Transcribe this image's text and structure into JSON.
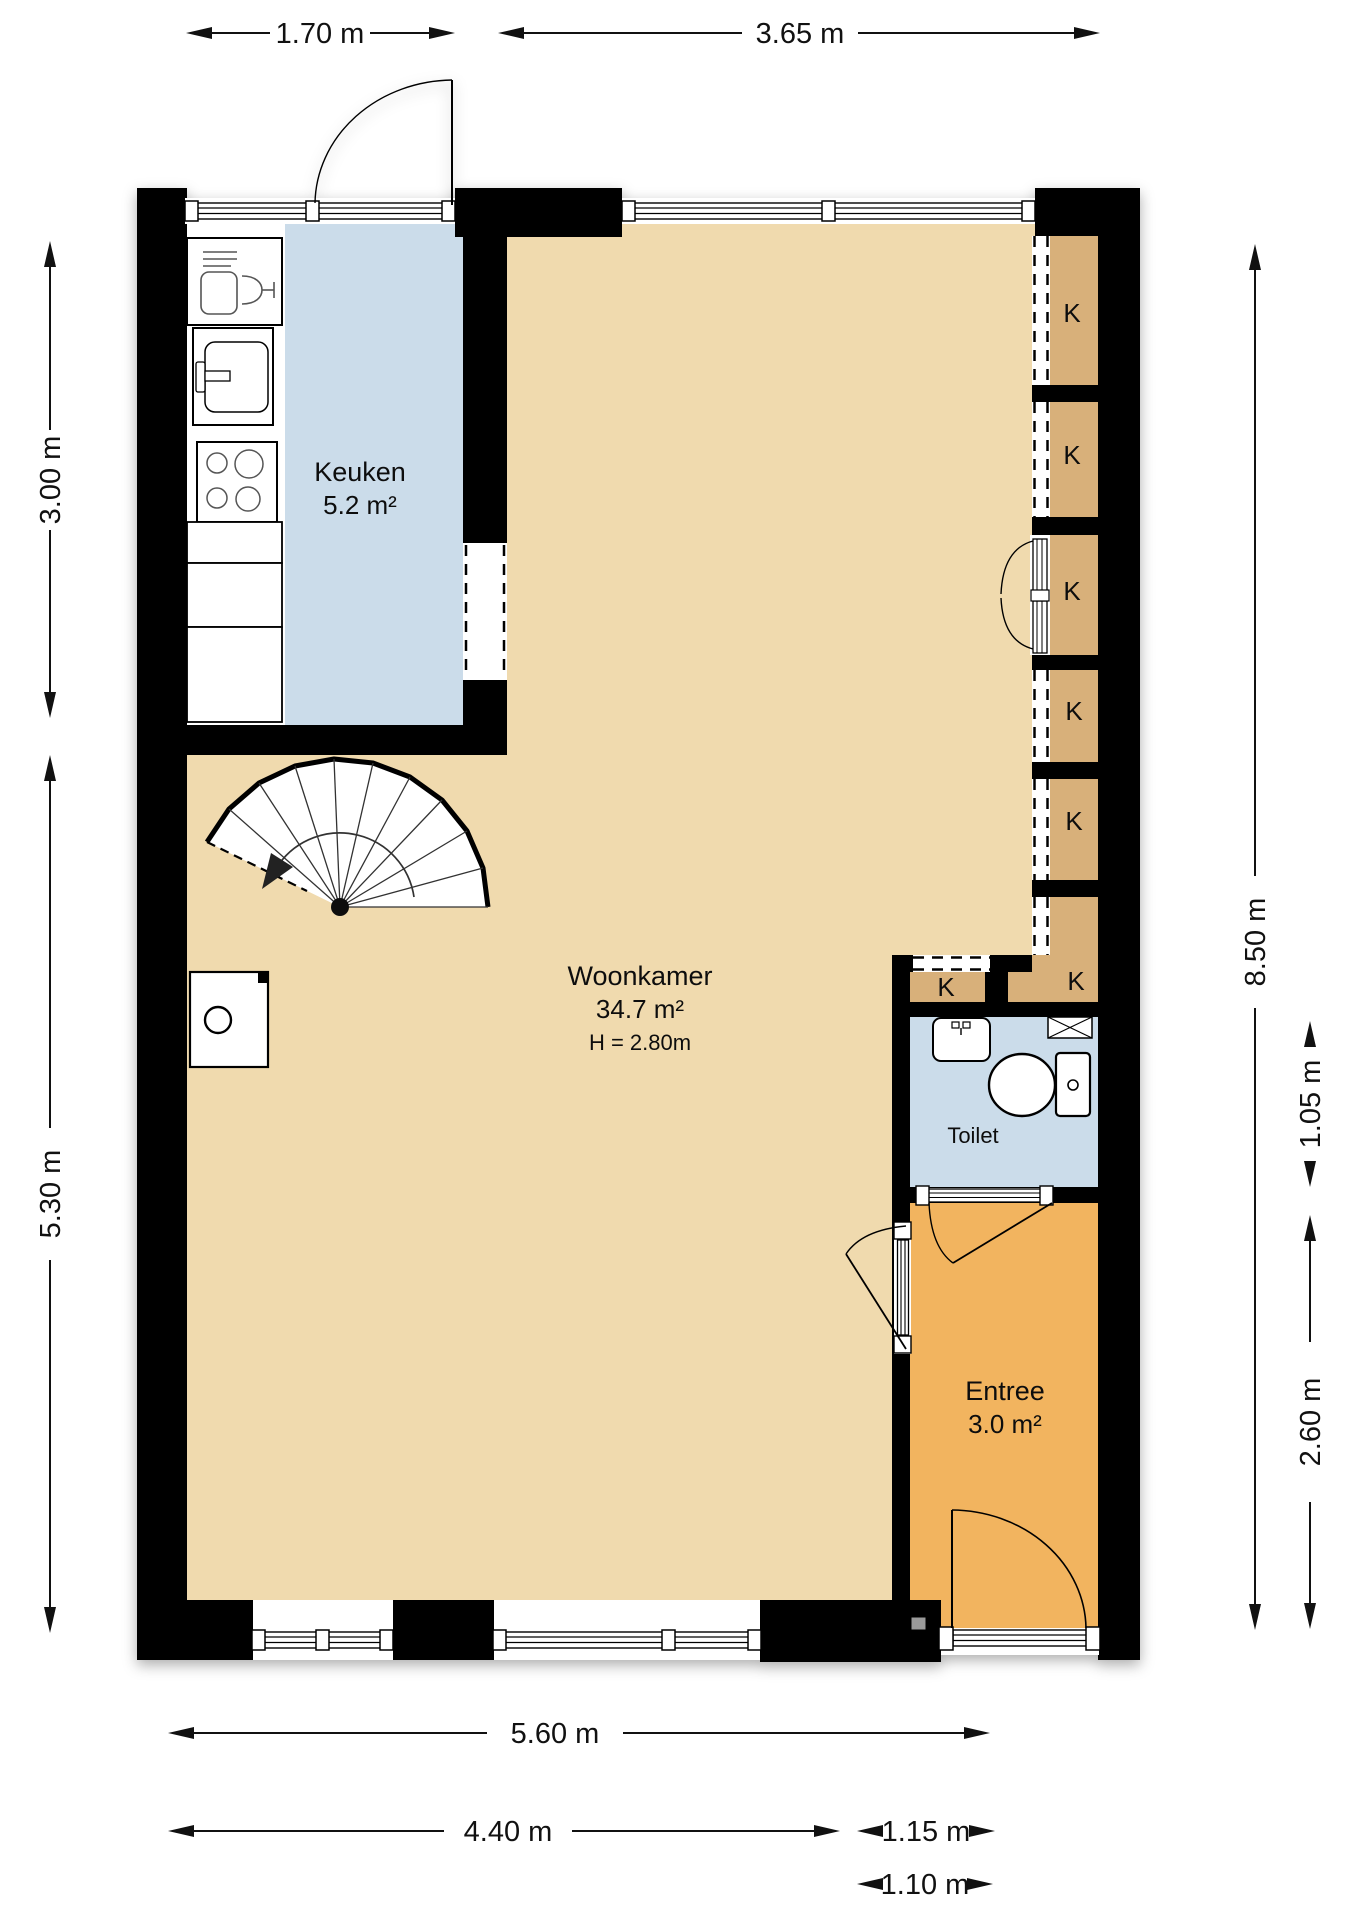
{
  "plan": {
    "type": "floorplan",
    "rooms": {
      "keuken": {
        "name": "Keuken",
        "area": "5.2 m²"
      },
      "woonkamer": {
        "name": "Woonkamer",
        "area": "34.7 m²",
        "height": "H = 2.80m"
      },
      "toilet": {
        "name": "Toilet"
      },
      "entree": {
        "name": "Entree",
        "area": "3.0 m²"
      }
    },
    "closets": {
      "label": "K"
    },
    "dimensions": {
      "width_kitchen": "1.70 m",
      "width_living_top": "3.65 m",
      "height_kitchen": "3.00 m",
      "height_living": "5.30 m",
      "height_total": "8.50 m",
      "height_toilet": "1.05 m",
      "height_entree": "2.60 m",
      "width_total": "5.60 m",
      "width_living_bottom": "4.40 m",
      "width_entree": "1.15 m",
      "width_frontdoor": "1.10 m"
    },
    "colors": {
      "wall": "#000000",
      "living": "#F0DAAE",
      "kitchen": "#CBDCEA",
      "toilet": "#CBDCEA",
      "closet": "#D8B07A",
      "entree": "#F2B45F",
      "stair": "#FFFFFF"
    }
  }
}
